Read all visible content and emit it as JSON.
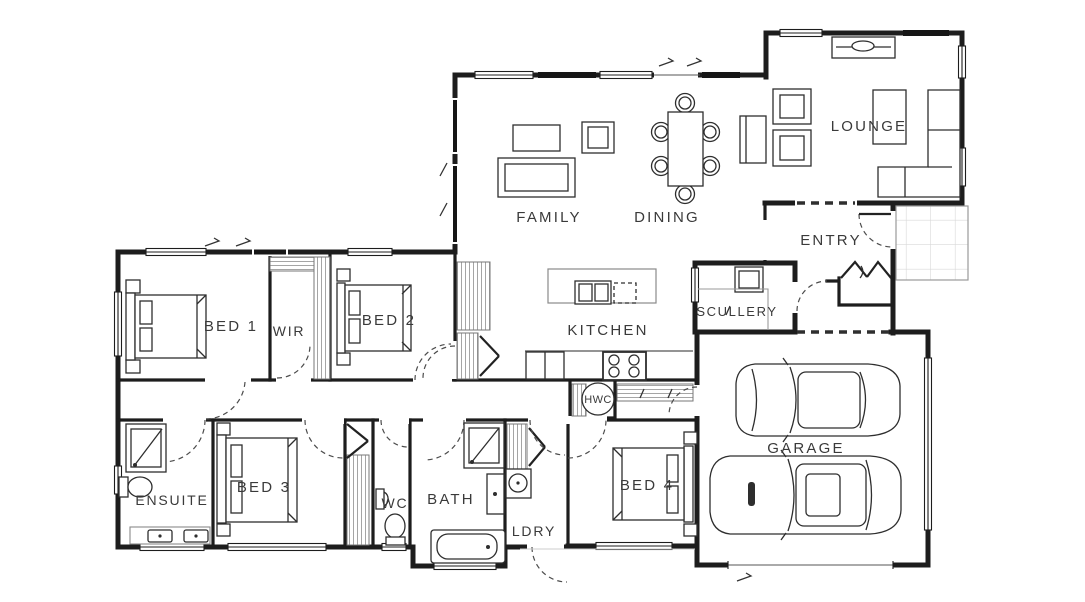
{
  "labels": {
    "family": "FAMILY",
    "dining": "DINING",
    "lounge": "LOUNGE",
    "entry": "ENTRY",
    "kitchen": "KITCHEN",
    "scullery": "SCULLERY",
    "hwc": "HWC",
    "bed1": "BED 1",
    "wir": "WIR",
    "bed2": "BED 2",
    "bed3": "BED 3",
    "ensuite": "ENSUITE",
    "wc": "WC",
    "bath": "BATH",
    "ldry": "LDRY",
    "bed4": "BED 4",
    "garage": "GARAGE"
  },
  "colors": {
    "wall": "#1d1d1d",
    "label": "#3a3a3a",
    "counter_gray": "#9a9a9a",
    "tile_gray": "#d9d9d9",
    "background": "#ffffff"
  }
}
